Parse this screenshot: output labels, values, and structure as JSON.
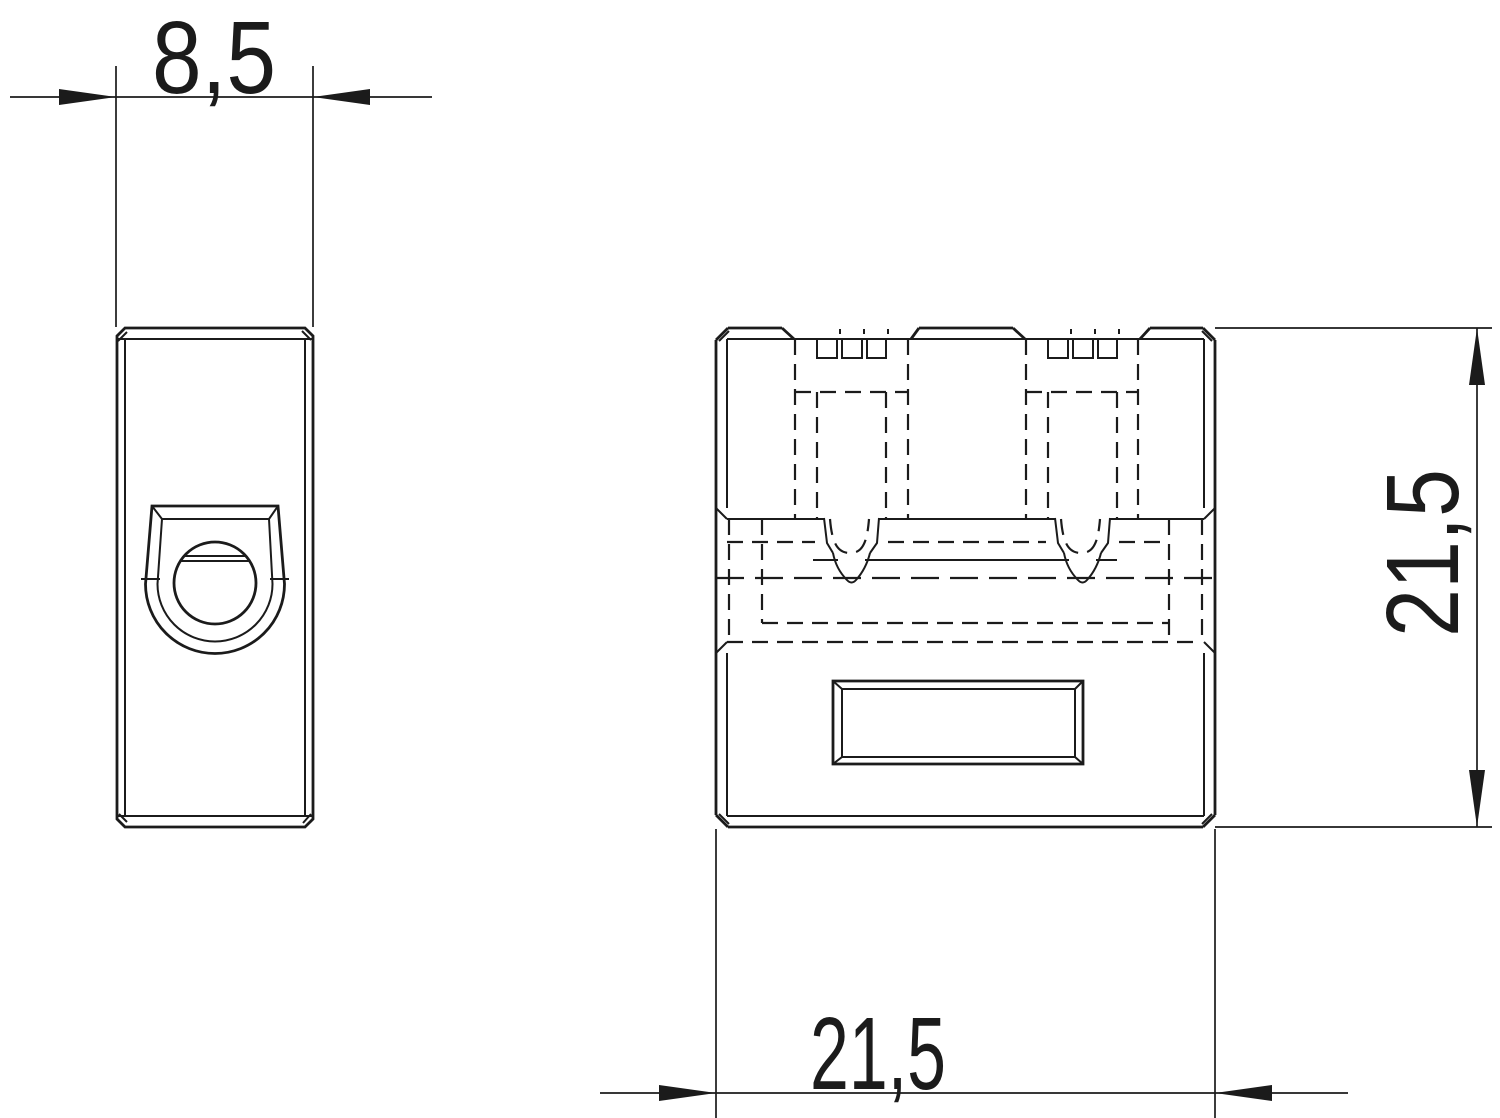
{
  "colors": {
    "ink": "#1b1b1b",
    "background": "#ffffff"
  },
  "dimensions": {
    "top_width": "8,5",
    "right_height": "21,5",
    "bottom_width": "21,5"
  }
}
